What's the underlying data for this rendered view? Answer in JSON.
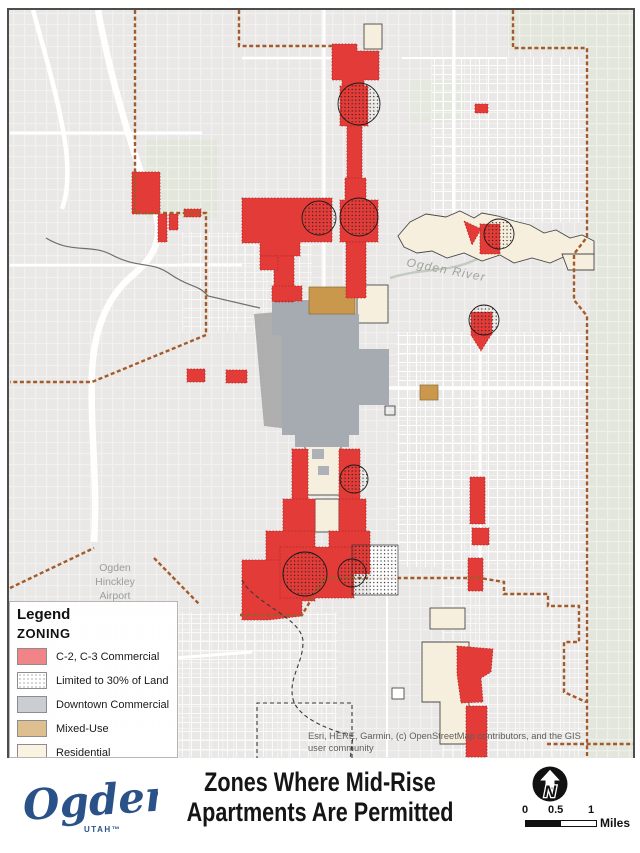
{
  "legend": {
    "title": "Legend",
    "subtitle": "ZONING",
    "items": [
      {
        "label": "C-2, C-3 Commercial",
        "color": "#F08486",
        "pattern": "solid"
      },
      {
        "label": "Limited to 30% of Land",
        "color": "#FFFFFF",
        "pattern": "dots"
      },
      {
        "label": "Downtown Commercial",
        "color": "#CACDD1",
        "pattern": "solid"
      },
      {
        "label": "Mixed-Use",
        "color": "#DDBF90",
        "pattern": "solid"
      },
      {
        "label": "Residential",
        "color": "#FAF3E2",
        "pattern": "solid"
      }
    ]
  },
  "map": {
    "labels": {
      "river": "Ogden River",
      "airport_line1": "Ogden",
      "airport_line2": "Hinckley",
      "airport_line3": "Airport"
    },
    "attribution": "Esri, HERE, Garmin, (c) OpenStreetMap contributors, and the GIS user community",
    "zone_colors": {
      "commercial_red": "#E23B38",
      "downtown_gray": "#A6AAB1",
      "mixed_use_tan": "#C9984C",
      "residential_cream": "#F6EFDD",
      "city_boundary": "#A35B2B"
    }
  },
  "footer": {
    "title_line1": "Zones Where Mid-Rise",
    "title_line2": "Apartments Are Permitted",
    "logo_text": "Ogden",
    "logo_sub": "UTAH™",
    "north_label": "N",
    "scale": {
      "t0": "0",
      "t1": "0.5",
      "t2": "1",
      "unit": "Miles"
    }
  }
}
